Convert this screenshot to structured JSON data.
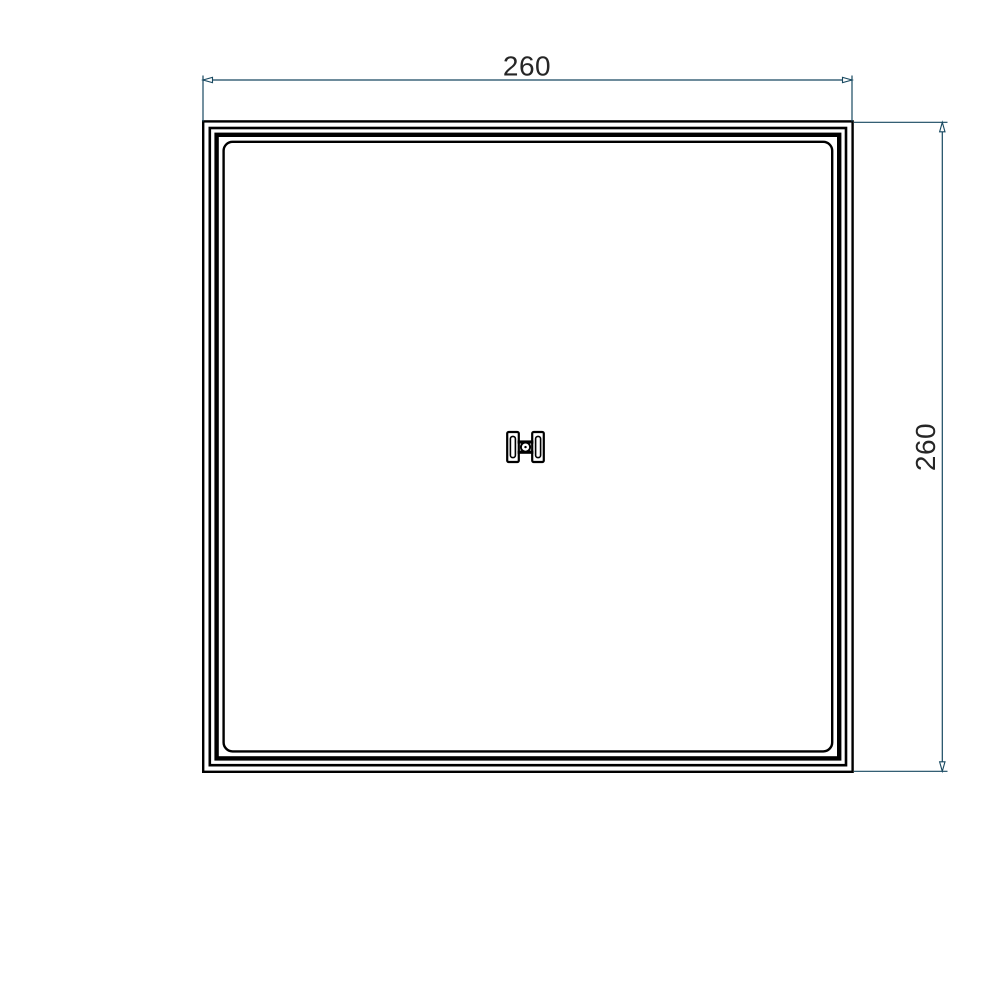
{
  "drawing": {
    "width_dimension": {
      "label": "260"
    },
    "height_dimension": {
      "label": "260"
    },
    "colors": {
      "background": "#ffffff",
      "part_outline": "#000000",
      "dimension_lines": "#174860",
      "dimension_text": "#262626"
    }
  }
}
